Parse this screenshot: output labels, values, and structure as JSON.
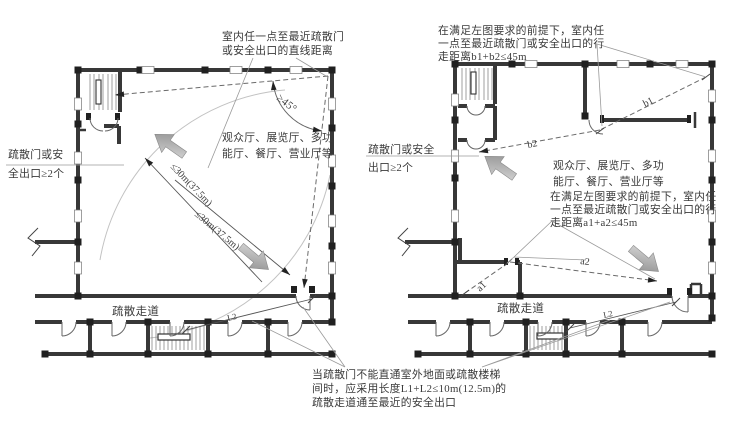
{
  "figure": {
    "background": "#ffffff",
    "wall_color": "#383838",
    "annotation_color": "#3a3a3a",
    "arrow_fill_light": "#dcdcdc",
    "arrow_fill_dark": "#8a8a8a"
  },
  "left_plan": {
    "top_note": {
      "line1": "室内任一点至最近疏散门",
      "line2": "或安全出口的直线距离"
    },
    "exit_note": {
      "line1": "疏散门或安",
      "line2": "全出口≥2个"
    },
    "room_label": {
      "line1": "观众厅、展览厅、多功",
      "line2": "能厅、餐厅、营业厅等"
    },
    "angle_label": "≥45°",
    "distance_label_upper": "≤30m(37.5m)",
    "distance_label_lower": "≤30m(37.5m)",
    "corridor_label": "疏散走道",
    "segment_label": "L2"
  },
  "right_plan": {
    "top_note": {
      "line1": "在满足左图要求的前提下，室内任",
      "line2": "一点至最近疏散门或安全出口的行",
      "line3": "走距离b1+b2≤45m"
    },
    "exit_note": {
      "line1": "疏散门或安全",
      "line2": "出口≥2个"
    },
    "room_label": {
      "line1": "观众厅、展览厅、多功",
      "line2": "能厅、餐厅、营业厅等"
    },
    "mid_note": {
      "line1": "在满足左图要求的前提下，室内任",
      "line2": "一点至最近疏散门或安全出口的行",
      "line3": "走距离a1+a2≤45m"
    },
    "b1_label": "b1",
    "b2_label": "b2",
    "a1_label": "a1",
    "a2_label": "a2",
    "corridor_label": "疏散走道",
    "segment_label": "L2"
  },
  "bottom_note": {
    "line1": "当疏散门不能直通室外地面或疏散楼梯",
    "line2": "间时，应采用长度L1+L2≤10m(12.5m)的",
    "line3": "疏散走道通至最近的安全出口"
  }
}
